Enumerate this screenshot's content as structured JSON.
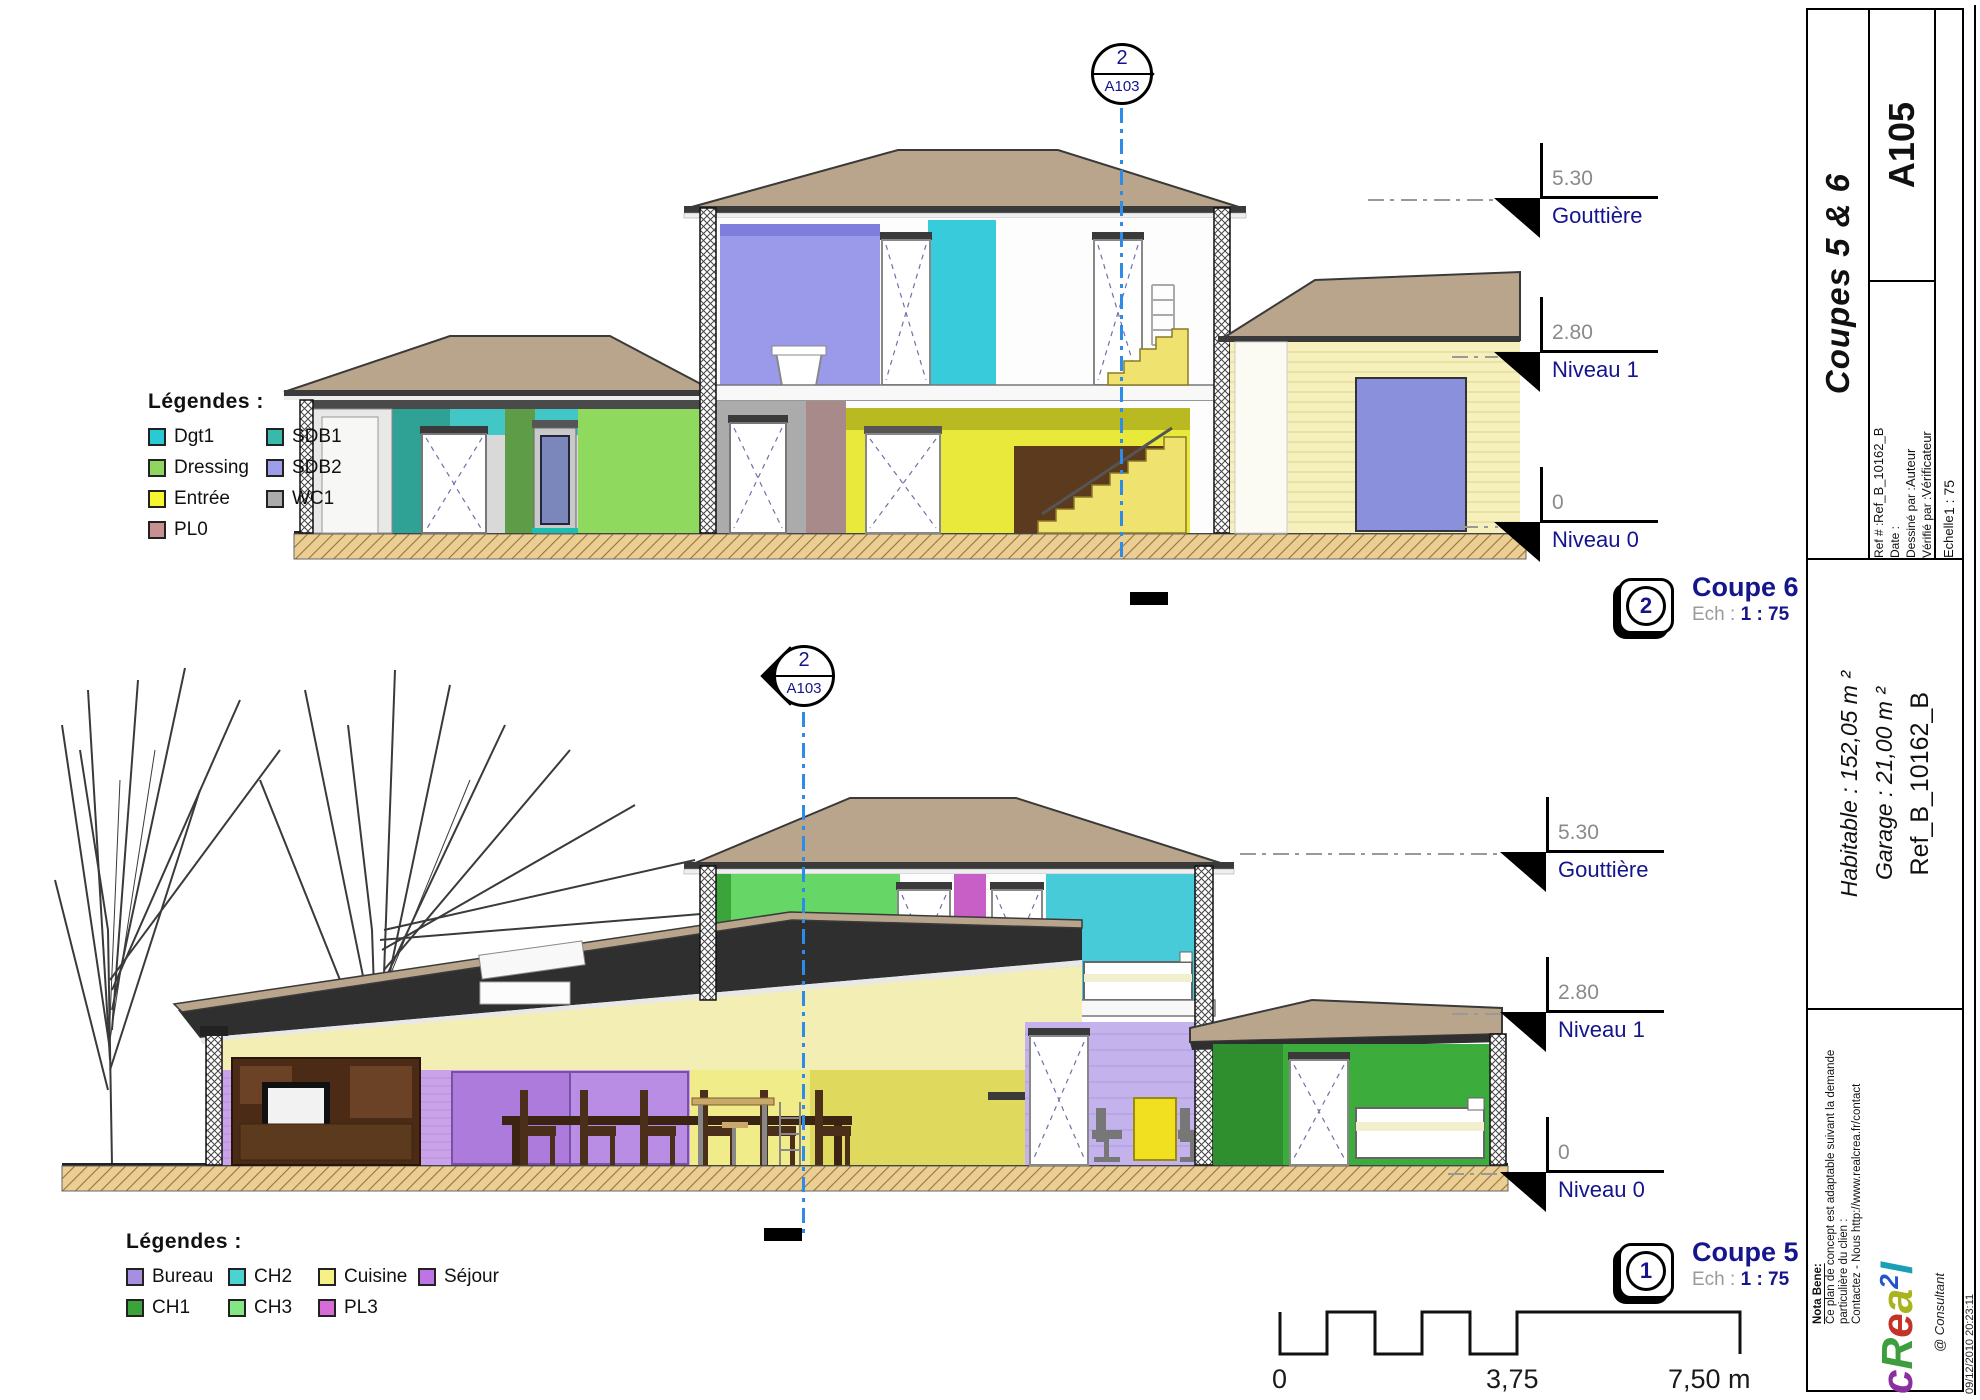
{
  "sheet": {
    "title": "Coupes 5 & 6",
    "number": "A105",
    "fields": {
      "ref_label": "Ref # :",
      "ref_value": "Ref_B_10162_B",
      "date_label": "Date :",
      "date_value": "",
      "drawn_label": "Dessiné par :",
      "drawn_value": "Auteur",
      "checked_label": "Vérifié par :",
      "checked_value": "Vérificateur",
      "scale_label": "Echelle",
      "scale_value": "1 : 75"
    },
    "areas": {
      "habitable": "Habitable : 152,05 m ²",
      "garage": "Garage : 21,00 m ²",
      "reference": "Ref_B_10162_B"
    },
    "nota": {
      "title": "Nota Bene:",
      "line1": "Ce plan de concept est adaptable suivant la demande",
      "line2": "particulière du clien :",
      "line3": "Contactez - Nous http://www.realcrea.fr/contact"
    },
    "consultant": "@ Consultant",
    "timestamp": "09/12/2010 20:23:11",
    "logo": {
      "l1": "c",
      "l2": "R",
      "l3": "e",
      "l4": "a",
      "sup": "2",
      "l5": "l"
    }
  },
  "colors": {
    "label_navy": "#16168C",
    "value_gray": "#8A8A8A",
    "section_line_blue": "#2E8BE8",
    "roof_tan": "#B9A58C",
    "ground_tan": "#EBCE93"
  },
  "legend_top": {
    "title": "Légendes :",
    "items": [
      {
        "label": "Dgt1",
        "color": "#29CAD4"
      },
      {
        "label": "Dressing",
        "color": "#8ED65F"
      },
      {
        "label": "Entrée",
        "color": "#F6F62E"
      },
      {
        "label": "PL0",
        "color": "#C79191"
      },
      {
        "label": "SDB1",
        "color": "#39B9A9"
      },
      {
        "label": "SDB2",
        "color": "#9D9DE9"
      },
      {
        "label": "WC1",
        "color": "#ABABAB"
      }
    ]
  },
  "legend_bottom": {
    "title": "Légendes :",
    "items": [
      {
        "label": "Bureau",
        "color": "#A68FE0"
      },
      {
        "label": "CH2",
        "color": "#49D3D3"
      },
      {
        "label": "Cuisine",
        "color": "#F6F187"
      },
      {
        "label": "Séjour",
        "color": "#BE74E4"
      },
      {
        "label": "CH1",
        "color": "#3AA43A"
      },
      {
        "label": "CH3",
        "color": "#83E883"
      },
      {
        "label": "PL3",
        "color": "#D76CD7"
      }
    ]
  },
  "coupe6": {
    "marker_number": "2",
    "marker_sheet": "A103",
    "icon_number": "2",
    "label": "Coupe 6",
    "ech_label": "Ech :",
    "ech_value": "1 : 75",
    "levels": [
      {
        "value": "5.30",
        "label": "Gouttière"
      },
      {
        "value": "2.80",
        "label": "Niveau 1"
      },
      {
        "value": "0",
        "label": "Niveau 0"
      }
    ]
  },
  "coupe5": {
    "marker_number": "2",
    "marker_sheet": "A103",
    "icon_number": "1",
    "label": "Coupe 5",
    "ech_label": "Ech :",
    "ech_value": "1 : 75",
    "levels": [
      {
        "value": "5.30",
        "label": "Gouttière"
      },
      {
        "value": "2.80",
        "label": "Niveau 1"
      },
      {
        "value": "0",
        "label": "Niveau 0"
      }
    ]
  },
  "scale_bar": {
    "start": "0",
    "middle": "3,75",
    "end": "7,50 m"
  }
}
